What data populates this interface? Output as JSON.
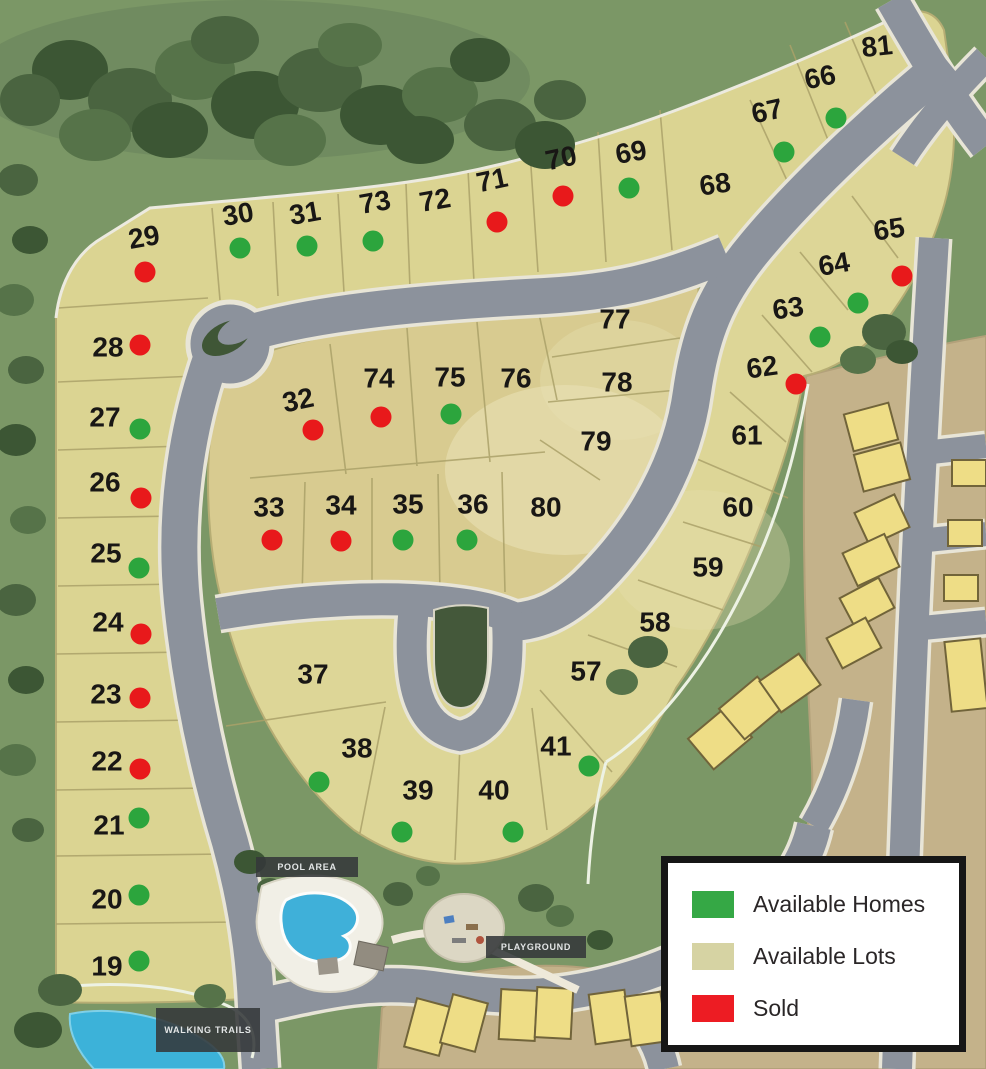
{
  "legend": {
    "items": [
      {
        "key": "available-homes",
        "label": "Available Homes",
        "color": "#35a845"
      },
      {
        "key": "available-lots",
        "label": "Available Lots",
        "color": "#d6d3a3"
      },
      {
        "key": "sold",
        "label": "Sold",
        "color": "#ed1c23"
      }
    ]
  },
  "status_colors": {
    "home": "#2ca53d",
    "sold": "#e8191b"
  },
  "amenity_labels": {
    "pool_area": "POOL AREA",
    "playground": "PLAYGROUND",
    "walking_trails": "WALKING TRAILS"
  },
  "lots": [
    {
      "number": "19",
      "x": 107,
      "y": 966,
      "status": "home",
      "dot": {
        "x": 139,
        "y": 961
      }
    },
    {
      "number": "20",
      "x": 107,
      "y": 899,
      "status": "home",
      "dot": {
        "x": 139,
        "y": 895
      }
    },
    {
      "number": "21",
      "x": 109,
      "y": 825,
      "status": "home",
      "dot": {
        "x": 139,
        "y": 818
      }
    },
    {
      "number": "22",
      "x": 107,
      "y": 761,
      "status": "sold",
      "dot": {
        "x": 140,
        "y": 769
      }
    },
    {
      "number": "23",
      "x": 106,
      "y": 694,
      "status": "sold",
      "dot": {
        "x": 140,
        "y": 698
      }
    },
    {
      "number": "24",
      "x": 108,
      "y": 622,
      "status": "sold",
      "dot": {
        "x": 141,
        "y": 634
      }
    },
    {
      "number": "25",
      "x": 106,
      "y": 553,
      "status": "home",
      "dot": {
        "x": 139,
        "y": 568
      }
    },
    {
      "number": "26",
      "x": 105,
      "y": 482,
      "status": "sold",
      "dot": {
        "x": 141,
        "y": 498
      }
    },
    {
      "number": "27",
      "x": 105,
      "y": 417,
      "status": "home",
      "dot": {
        "x": 140,
        "y": 429
      }
    },
    {
      "number": "28",
      "x": 108,
      "y": 347,
      "status": "sold",
      "dot": {
        "x": 140,
        "y": 345
      }
    },
    {
      "number": "29",
      "x": 144,
      "y": 237,
      "rot": -10,
      "status": "sold",
      "dot": {
        "x": 145,
        "y": 272
      }
    },
    {
      "number": "30",
      "x": 238,
      "y": 214,
      "rot": -10,
      "status": "home",
      "dot": {
        "x": 240,
        "y": 248
      }
    },
    {
      "number": "31",
      "x": 305,
      "y": 213,
      "rot": -10,
      "status": "home",
      "dot": {
        "x": 307,
        "y": 246
      }
    },
    {
      "number": "32",
      "x": 298,
      "y": 400,
      "rot": -12,
      "status": "sold",
      "dot": {
        "x": 313,
        "y": 430
      }
    },
    {
      "number": "33",
      "x": 269,
      "y": 507,
      "status": "sold",
      "dot": {
        "x": 272,
        "y": 540
      }
    },
    {
      "number": "34",
      "x": 341,
      "y": 505,
      "status": "sold",
      "dot": {
        "x": 341,
        "y": 541
      }
    },
    {
      "number": "35",
      "x": 408,
      "y": 504,
      "status": "home",
      "dot": {
        "x": 403,
        "y": 540
      }
    },
    {
      "number": "36",
      "x": 473,
      "y": 504,
      "status": "home",
      "dot": {
        "x": 467,
        "y": 540
      }
    },
    {
      "number": "37",
      "x": 313,
      "y": 674,
      "status": "lot"
    },
    {
      "number": "38",
      "x": 357,
      "y": 748,
      "status": "home",
      "dot": {
        "x": 319,
        "y": 782
      }
    },
    {
      "number": "39",
      "x": 418,
      "y": 790,
      "status": "home",
      "dot": {
        "x": 402,
        "y": 832
      }
    },
    {
      "number": "40",
      "x": 494,
      "y": 790,
      "status": "home",
      "dot": {
        "x": 513,
        "y": 832
      }
    },
    {
      "number": "41",
      "x": 556,
      "y": 746,
      "status": "home",
      "dot": {
        "x": 589,
        "y": 766
      }
    },
    {
      "number": "57",
      "x": 586,
      "y": 671,
      "status": "lot"
    },
    {
      "number": "58",
      "x": 655,
      "y": 622,
      "status": "lot"
    },
    {
      "number": "59",
      "x": 708,
      "y": 567,
      "status": "lot"
    },
    {
      "number": "60",
      "x": 738,
      "y": 507,
      "status": "lot"
    },
    {
      "number": "61",
      "x": 747,
      "y": 435,
      "status": "lot"
    },
    {
      "number": "62",
      "x": 762,
      "y": 367,
      "rot": -8,
      "status": "sold",
      "dot": {
        "x": 796,
        "y": 384
      }
    },
    {
      "number": "63",
      "x": 788,
      "y": 308,
      "rot": -8,
      "status": "home",
      "dot": {
        "x": 820,
        "y": 337
      }
    },
    {
      "number": "64",
      "x": 834,
      "y": 264,
      "rot": -10,
      "status": "home",
      "dot": {
        "x": 858,
        "y": 303
      }
    },
    {
      "number": "65",
      "x": 889,
      "y": 229,
      "rot": -8,
      "status": "sold",
      "dot": {
        "x": 902,
        "y": 276
      }
    },
    {
      "number": "66",
      "x": 820,
      "y": 77,
      "rot": -12,
      "status": "home",
      "dot": {
        "x": 836,
        "y": 118
      }
    },
    {
      "number": "67",
      "x": 767,
      "y": 111,
      "rot": -12,
      "status": "home",
      "dot": {
        "x": 784,
        "y": 152
      }
    },
    {
      "number": "68",
      "x": 715,
      "y": 184,
      "rot": -8,
      "status": "lot"
    },
    {
      "number": "69",
      "x": 631,
      "y": 152,
      "rot": -10,
      "status": "home",
      "dot": {
        "x": 629,
        "y": 188
      }
    },
    {
      "number": "70",
      "x": 561,
      "y": 158,
      "rot": -12,
      "status": "sold",
      "dot": {
        "x": 563,
        "y": 196
      }
    },
    {
      "number": "71",
      "x": 492,
      "y": 180,
      "rot": -12,
      "status": "sold",
      "dot": {
        "x": 497,
        "y": 222
      }
    },
    {
      "number": "72",
      "x": 435,
      "y": 200,
      "rot": -10,
      "status": "lot"
    },
    {
      "number": "73",
      "x": 375,
      "y": 202,
      "rot": -10,
      "status": "home",
      "dot": {
        "x": 373,
        "y": 241
      }
    },
    {
      "number": "74",
      "x": 379,
      "y": 378,
      "status": "sold",
      "dot": {
        "x": 381,
        "y": 417
      }
    },
    {
      "number": "75",
      "x": 450,
      "y": 377,
      "status": "home",
      "dot": {
        "x": 451,
        "y": 414
      }
    },
    {
      "number": "76",
      "x": 516,
      "y": 378,
      "status": "lot"
    },
    {
      "number": "77",
      "x": 615,
      "y": 319,
      "status": "lot"
    },
    {
      "number": "78",
      "x": 617,
      "y": 382,
      "status": "lot"
    },
    {
      "number": "79",
      "x": 596,
      "y": 441,
      "status": "lot"
    },
    {
      "number": "80",
      "x": 546,
      "y": 507,
      "status": "lot"
    },
    {
      "number": "81",
      "x": 877,
      "y": 46,
      "rot": -6,
      "status": "lot"
    }
  ]
}
